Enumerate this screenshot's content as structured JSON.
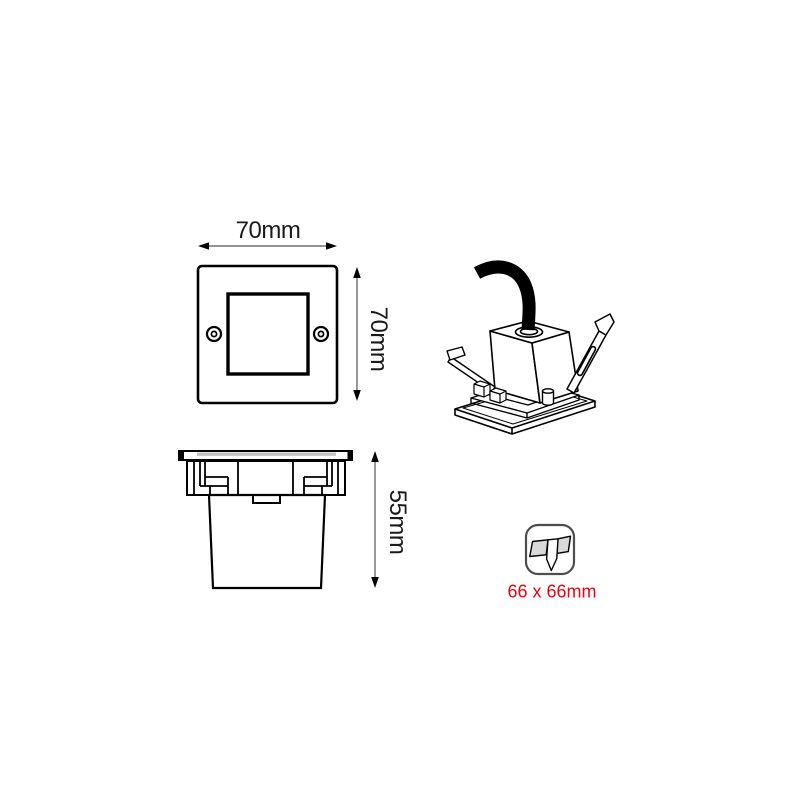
{
  "page": {
    "description": "Technical dimension drawing of a square recessed wall light fixture",
    "background": "#ffffff"
  },
  "colors": {
    "line": "#000000",
    "dimension_line": "#555555",
    "accent_red": "#e30613",
    "fill_gray": "#d9d9d9",
    "flange_gray": "#bfbfbf",
    "icon_border": "#4d4d4d"
  },
  "front_view": {
    "name": "front face view",
    "width_dim": "70mm",
    "height_dim": "70mm"
  },
  "side_view": {
    "name": "side recessed view",
    "depth_dim": "55mm"
  },
  "perspective_view": {
    "name": "3d perspective view with cable and spring clips"
  },
  "cutout": {
    "icon": "cutout-hole-icon",
    "label": "66 x 66mm"
  }
}
